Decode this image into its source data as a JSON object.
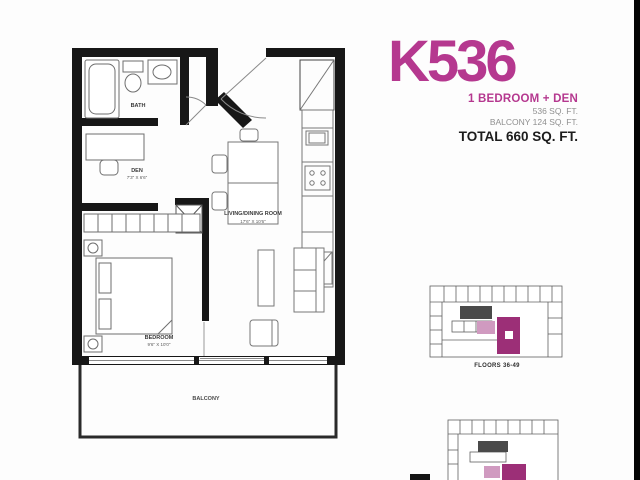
{
  "colors": {
    "magenta": "#b5388f",
    "keyplan_magenta": "#9c2f77",
    "wall": "#171717",
    "gray_text": "#8f8f8f"
  },
  "header": {
    "unit_code": "K536",
    "unit_type": "1 BEDROOM + DEN",
    "interior_area": "536 SQ. FT.",
    "balcony_area": "BALCONY 124 SQ. FT.",
    "total_area": "TOTAL 660 SQ. FT."
  },
  "plan": {
    "bath_label": "BATH",
    "den_label": "DEN",
    "den_dims": "7'3\" X 6'6\"",
    "living_label": "LIVING/DINING ROOM",
    "living_dims": "17'6\" X 10'6\"",
    "bedroom_label": "BEDROOM",
    "bedroom_dims": "9'6\" X 10'0\"",
    "balcony_label": "BALCONY"
  },
  "keyplans": {
    "caption1": "FLOORS 36-49"
  }
}
